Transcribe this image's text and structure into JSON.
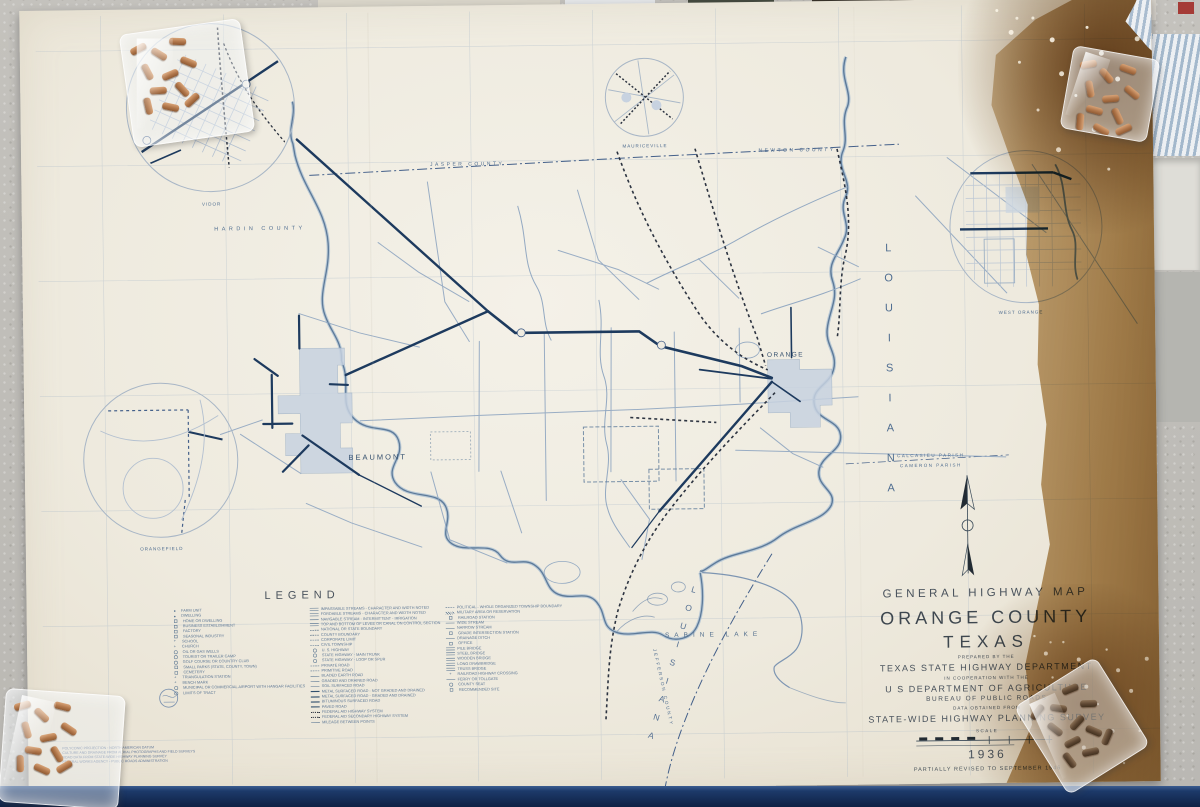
{
  "map": {
    "title_block": {
      "line1": "GENERAL HIGHWAY MAP",
      "county": "ORANGE COUNTY",
      "state": "TEXAS",
      "prepared_by": "PREPARED BY THE",
      "agency": "TEXAS STATE HIGHWAY DEPARTMENT",
      "cooperation": "IN COOPERATION WITH THE",
      "usda": "U S DEPARTMENT OF AGRICULTURE",
      "bureau": "BUREAU OF PUBLIC ROADS",
      "data_from": "DATA OBTAINED FROM",
      "survey": "STATE-WIDE HIGHWAY PLANNING SURVEY",
      "scale_label": "SCALE",
      "year": "1936",
      "revision": "PARTIALLY REVISED TO   SEPTEMBER 1946"
    },
    "legend": {
      "title": "LEGEND",
      "columns": [
        [
          {
            "s": "dot",
            "l": "FARM UNIT"
          },
          {
            "s": "dot",
            "l": "DWELLING"
          },
          {
            "s": "square",
            "l": "HOME OR DWELLING"
          },
          {
            "s": "square",
            "l": "BUSINESS ESTABLISHMENT"
          },
          {
            "s": "square",
            "l": "FACTORY"
          },
          {
            "s": "square",
            "l": "SEASONAL INDUSTRY"
          },
          {
            "s": "cross",
            "l": "SCHOOL"
          },
          {
            "s": "cross",
            "l": "CHURCH"
          },
          {
            "s": "circle",
            "l": "OIL OR GAS WELLS"
          },
          {
            "s": "circle",
            "l": "TOURIST OR TRAILER CAMP"
          },
          {
            "s": "circle",
            "l": "GOLF COURSE OR COUNTRY CLUB"
          },
          {
            "s": "square",
            "l": "SMALL PARKS (STATE, COUNTY, TOWN)"
          },
          {
            "s": "square",
            "l": "CEMETERY"
          },
          {
            "s": "cross",
            "l": "TRIANGULATION STATION"
          },
          {
            "s": "cross",
            "l": "BENCH MARK"
          },
          {
            "s": "circle",
            "l": "MUNICIPAL OR COMMERCIAL AIRPORT WITH HANGAR FACILITIES"
          },
          {
            "s": "circle",
            "l": "LIMITS OF TRACT"
          }
        ],
        [
          {
            "s": "double",
            "l": "IMPASSABLE STREAMS - CHARACTER AND WIDTH NOTED"
          },
          {
            "s": "double",
            "l": "FORDABLE STREAMS - CHARACTER AND WIDTH NOTED"
          },
          {
            "s": "line",
            "l": "NAVIGABLE STREAM - INTERMITTENT - IRRIGATION"
          },
          {
            "s": "double",
            "l": "TOP AND BOTTOM OF LEVEE OR CANAL ON CONTROL SECTION"
          },
          {
            "s": "dashdot",
            "l": "NATIONAL OR STATE BOUNDARY"
          },
          {
            "s": "dashdot",
            "l": "COUNTY BOUNDARY"
          },
          {
            "s": "dash",
            "l": "CORPORATE LIMIT"
          },
          {
            "s": "dash",
            "l": "CIVIL TOWNSHIP"
          },
          {
            "s": "circle",
            "l": "U. S. HIGHWAY"
          },
          {
            "s": "circle",
            "l": "STATE HIGHWAY - MAIN TRUNK"
          },
          {
            "s": "circle",
            "l": "STATE HIGHWAY - LOOP OR SPUR"
          },
          {
            "s": "dash",
            "l": "PRIVATE ROAD"
          },
          {
            "s": "dash",
            "l": "PRIMITIVE ROAD"
          },
          {
            "s": "line",
            "l": "BLADED EARTH ROAD"
          },
          {
            "s": "line",
            "l": "GRADED AND DRAINED ROAD"
          },
          {
            "s": "line",
            "l": "SOIL SURFACED ROAD"
          },
          {
            "s": "bold",
            "l": "METAL SURFACED ROAD - NOT GRADED AND DRAINED"
          },
          {
            "s": "bold",
            "l": "METAL SURFACED ROAD - GRADED AND DRAINED"
          },
          {
            "s": "bold",
            "l": "BITUMINOUS SURFACED ROAD"
          },
          {
            "s": "bold",
            "l": "PAVED ROAD"
          },
          {
            "s": "rail",
            "l": "FEDERAL AID HIGHWAY SYSTEM"
          },
          {
            "s": "rail",
            "l": "FEDERAL AID SECONDARY HIGHWAY SYSTEM"
          },
          {
            "s": "line",
            "l": "MILEAGE BETWEEN POINTS"
          }
        ],
        [
          {
            "s": "dash",
            "l": "POLITICAL - WHOLE ORGANIZED TOWNSHIP BOUNDARY"
          },
          {
            "s": "hatch",
            "l": "MILITARY AREA OR RESERVATION"
          },
          {
            "s": "square",
            "l": "RAILROAD STATION"
          },
          {
            "s": "line",
            "l": "WIDE STREAM"
          },
          {
            "s": "line",
            "l": "NARROW STREAM"
          },
          {
            "s": "square",
            "l": "GRADE INTERSECTION STATION"
          },
          {
            "s": "line",
            "l": "DRAINAGE DITCH"
          },
          {
            "s": "square",
            "l": "OFFICE"
          },
          {
            "s": "double",
            "l": "PILE BRIDGE"
          },
          {
            "s": "double",
            "l": "STEEL BRIDGE"
          },
          {
            "s": "double",
            "l": "WOODEN BRIDGE"
          },
          {
            "s": "double",
            "l": "LONG DRAWBRIDGE"
          },
          {
            "s": "double",
            "l": "TRUSS BRIDGE"
          },
          {
            "s": "cross",
            "l": "RAILROAD HIGHWAY CROSSING"
          },
          {
            "s": "line",
            "l": "FERRY OR TOLLGATE"
          },
          {
            "s": "circle",
            "l": "COUNTY SEAT"
          },
          {
            "s": "square",
            "l": "RECOMMENDED SITE"
          }
        ]
      ]
    },
    "places": {
      "beaumont": "BEAUMONT",
      "orange": "ORANGE",
      "vidor": "VIDOR",
      "mauriceville": "MAURICEVILLE",
      "west_orange": "WEST ORANGE",
      "orangefield": "ORANGEFIELD"
    },
    "counties": {
      "hardin": "HARDIN COUNTY",
      "jasper": "JASPER COUNTY",
      "newton": "NEWTON COUNTY",
      "jefferson": "JEFFERSON COUNTY"
    },
    "state_labels": {
      "louisiana_east": "LOUISIANA",
      "louisiana_south": "LOUISIANA"
    },
    "water_labels": {
      "sabine_lake": "SABINE LAKE"
    },
    "parish_labels": {
      "calcasieu": "CALCASIEU PARISH",
      "cameron": "CAMERON PARISH"
    },
    "notes": [
      "POLYCONIC PROJECTION - NORTH AMERICAN DATUM",
      "CULTURE AND DRAINAGE FROM AERIAL PHOTOGRAPHS AND FIELD SURVEYS",
      "ROAD DATA FROM STATE-WIDE HIGHWAY PLANNING SURVEY",
      "FEDERAL WORKS AGENCY - PUBLIC ROADS ADMINISTRATION"
    ]
  },
  "background": {
    "book_text": "1993 McC"
  },
  "colors": {
    "map_line": "#8aa2bf",
    "map_bold": "#1d3a5e",
    "rail": "#2c3340",
    "urban_fill": "#c7d2e0",
    "stain": "#a97b46",
    "sheet": "#efebe0",
    "navy_band": "#16305c",
    "title_text": "#49525c",
    "label_blue": "#4f6d90"
  }
}
